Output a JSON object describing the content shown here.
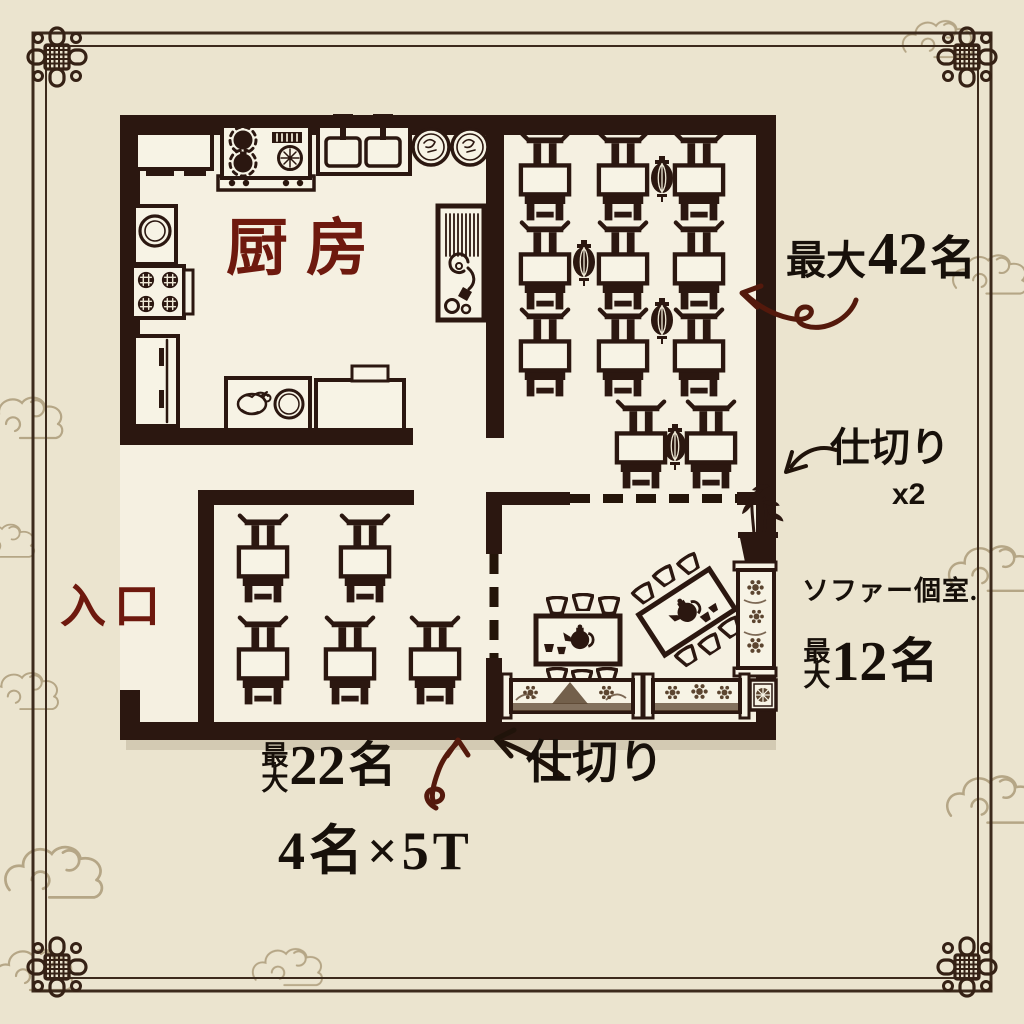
{
  "palette": {
    "page_bg": "#ebe4cf",
    "floor_bg": "#f5f0e1",
    "wall": "#2b1710",
    "room_label_red": "#6e190e",
    "ink": "#17100a",
    "arrow_red": "#54190c",
    "border_line": "#3c2a1c",
    "cloud": "#a89674",
    "sofa_pattern": "#5c4530"
  },
  "rooms": {
    "kitchen": {
      "label": "厨房"
    },
    "entrance": {
      "label": "入口"
    },
    "main_dining": {
      "max_label": "最大",
      "count": "42",
      "unit": "名",
      "tables": 11,
      "lanterns": 4
    },
    "lower_dining": {
      "max_label": "最大",
      "count": "22",
      "unit": "名",
      "breakdown": "4名×5T",
      "tables": 5
    },
    "sofa_room": {
      "label": "ソファー個室.",
      "max_label": "最大",
      "count": "12",
      "unit": "名"
    }
  },
  "partitions": {
    "right_label": "仕切り",
    "right_count": "x2",
    "bottom_label": "仕切り"
  },
  "furniture": {
    "dining_tables": [
      [
        518,
        130
      ],
      [
        596,
        130
      ],
      [
        672,
        130
      ],
      [
        518,
        219
      ],
      [
        596,
        219
      ],
      [
        672,
        219
      ],
      [
        518,
        306
      ],
      [
        596,
        306
      ],
      [
        672,
        306
      ],
      [
        614,
        398
      ],
      [
        684,
        398
      ]
    ],
    "lower_tables": [
      [
        236,
        512
      ],
      [
        338,
        512
      ],
      [
        236,
        614
      ],
      [
        323,
        614
      ],
      [
        408,
        614
      ]
    ],
    "lanterns": [
      [
        650,
        156
      ],
      [
        572,
        240
      ],
      [
        650,
        298
      ],
      [
        663,
        424
      ]
    ]
  },
  "icons": {
    "dining_table_set": "table-with-chair",
    "lantern": "paper-lantern",
    "teapot": "teapot",
    "teacup": "teacup",
    "bamboo_plant": "potted-bamboo",
    "sofa": "ornate-bench-sofa",
    "corner_knot": "chinese-knot",
    "cloud": "cloud-scroll"
  }
}
